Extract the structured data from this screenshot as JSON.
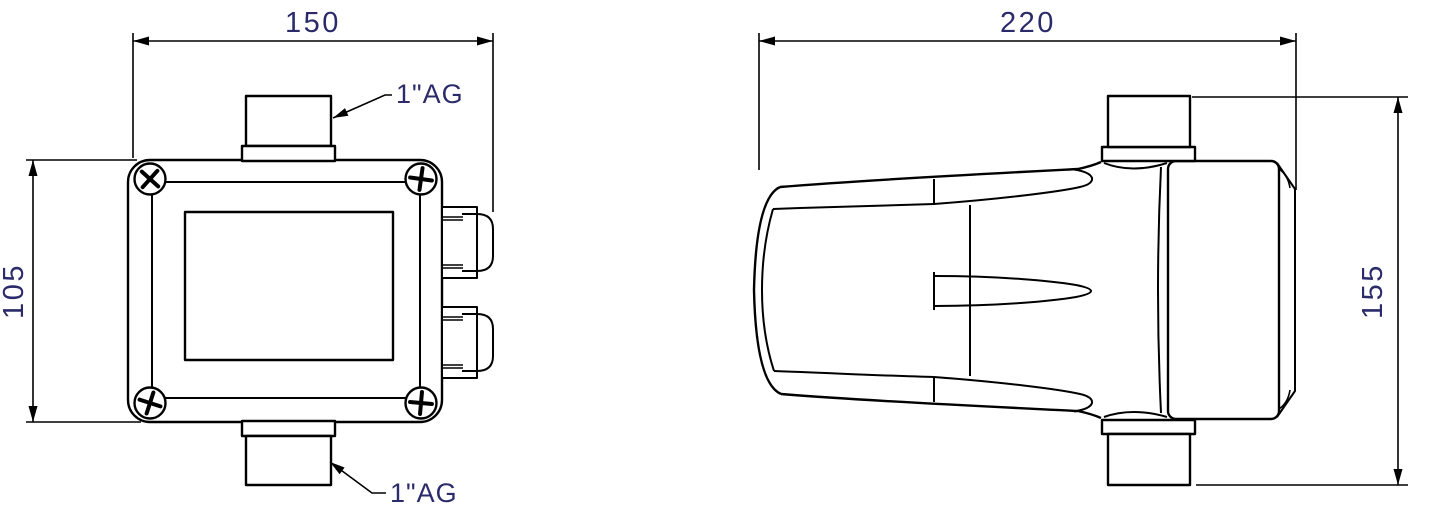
{
  "drawing": {
    "front_view": {
      "width_dim": "150",
      "height_dim": "105",
      "top_port_label": "1\"AG",
      "bottom_port_label": "1\"AG"
    },
    "side_view": {
      "width_dim": "220",
      "height_dim": "155"
    },
    "colors": {
      "dimension_text": "#2b2b6b",
      "line": "#000000",
      "background": "#ffffff"
    }
  }
}
